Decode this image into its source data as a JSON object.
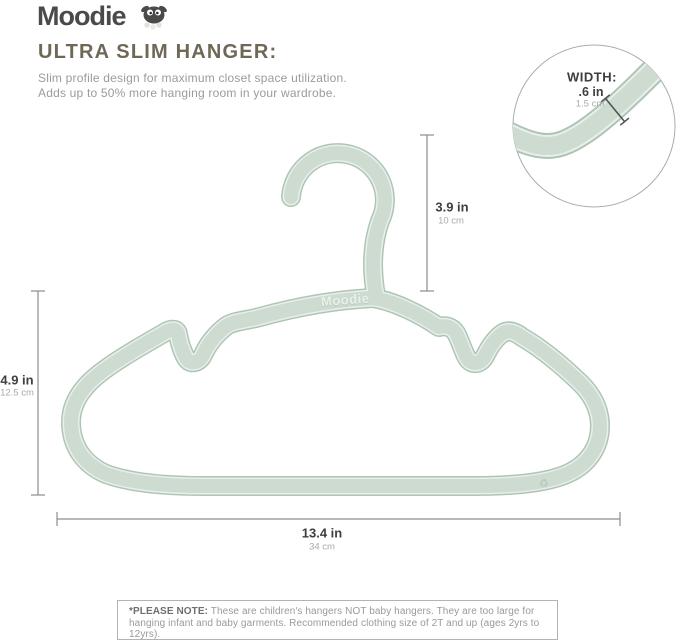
{
  "brand": {
    "logo_text": "Moodie",
    "mascot_icon": "sheep-icon"
  },
  "header": {
    "title": "ULTRA SLIM HANGER:",
    "description_line1": "Slim profile design for maximum closet space utilization.",
    "description_line2": "Adds up to 50% more hanging room in your wardrobe."
  },
  "inset": {
    "label": "WIDTH:",
    "value_in": ".6 in",
    "value_cm": "1.5 cm"
  },
  "dimensions": {
    "hook_height": {
      "in": "3.9 in",
      "cm": "10 cm"
    },
    "hanger_height": {
      "in": "4.9 in",
      "cm": "12.5 cm"
    },
    "hanger_width": {
      "in": "13.4 in",
      "cm": "34 cm"
    }
  },
  "hanger": {
    "embossed_text": "Moodie",
    "recycle_icon": "♻"
  },
  "note": {
    "label": "*PLEASE NOTE:",
    "text": " These are children's hangers NOT baby hangers.  They are too large for hanging infant and baby garments.  Recommended clothing size of 2T and up (ages 2yrs to 12yrs)."
  },
  "colors": {
    "hanger_main": "#cddbd1",
    "hanger_edge": "#aec5b6",
    "hanger_highlight": "#e9efe9",
    "title": "#6f6857",
    "text_dark": "#3f3f3f",
    "text_gray": "#9b9b9b",
    "dimension_line": "#8d8d8d",
    "logo": "#4a4a48"
  }
}
